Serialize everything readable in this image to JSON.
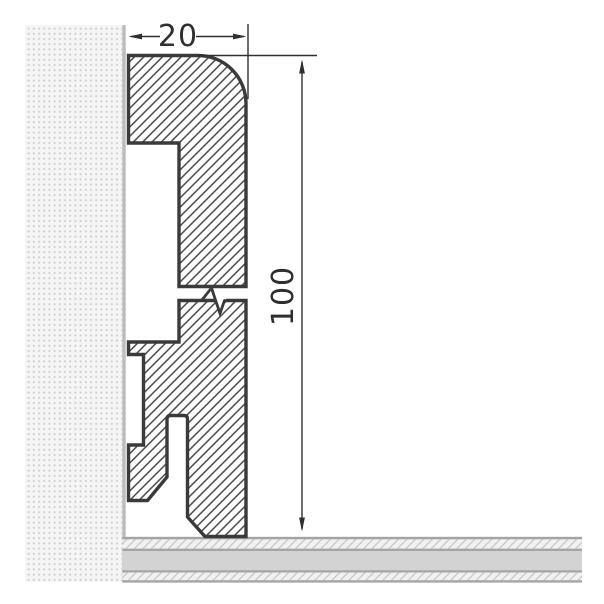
{
  "dimensions": {
    "width": {
      "label": "20"
    },
    "height": {
      "label": "100"
    }
  },
  "colors": {
    "bg": "#ffffff",
    "outline": "#3a3a3a",
    "hatch-line": "#3c3c3c",
    "dim": "#2f2f2f",
    "wall-bg": "#f5f5f5",
    "wall-dot": "#cacaca",
    "wall-edge": "#bcbcbc",
    "floor-border": "#a5a5a5",
    "floor-fill": "#d3d3d3",
    "floor-hatch-bg": "#f1f1f1",
    "floor-hatch-line": "#c5c5c5"
  }
}
